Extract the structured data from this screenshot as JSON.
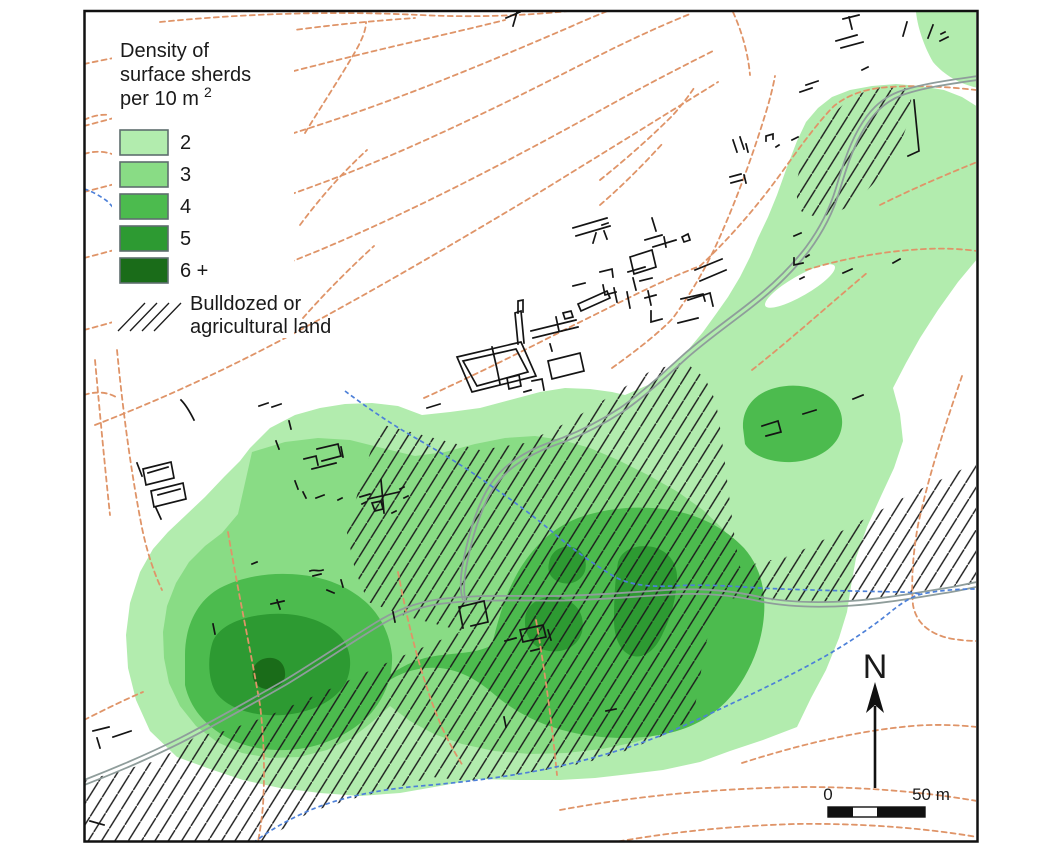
{
  "legend": {
    "title_lines": [
      "Density of",
      "surface sherds",
      "per 10 m"
    ],
    "title_unit_superscript": "2",
    "density_classes": [
      {
        "label": "2",
        "color": "#B2ECAE"
      },
      {
        "label": "3",
        "color": "#89DC85"
      },
      {
        "label": "4",
        "color": "#4CBB4E"
      },
      {
        "label": "5",
        "color": "#2D9A32"
      },
      {
        "label": "6 +",
        "color": "#1A6C19"
      }
    ],
    "hatch_label_lines": [
      "Bulldozed or",
      "agricultural land"
    ]
  },
  "north_arrow": {
    "label": "N"
  },
  "scale_bar": {
    "start_label": "0",
    "end_label": "50 m"
  },
  "colors": {
    "contour_line": "#DF9468",
    "stream_line": "#4D80D8",
    "road_line": "#8F9D9B",
    "hatch_line": "#1C1C1C",
    "building_line": "#141414",
    "frame": "#111111",
    "background": "#FFFFFF"
  }
}
